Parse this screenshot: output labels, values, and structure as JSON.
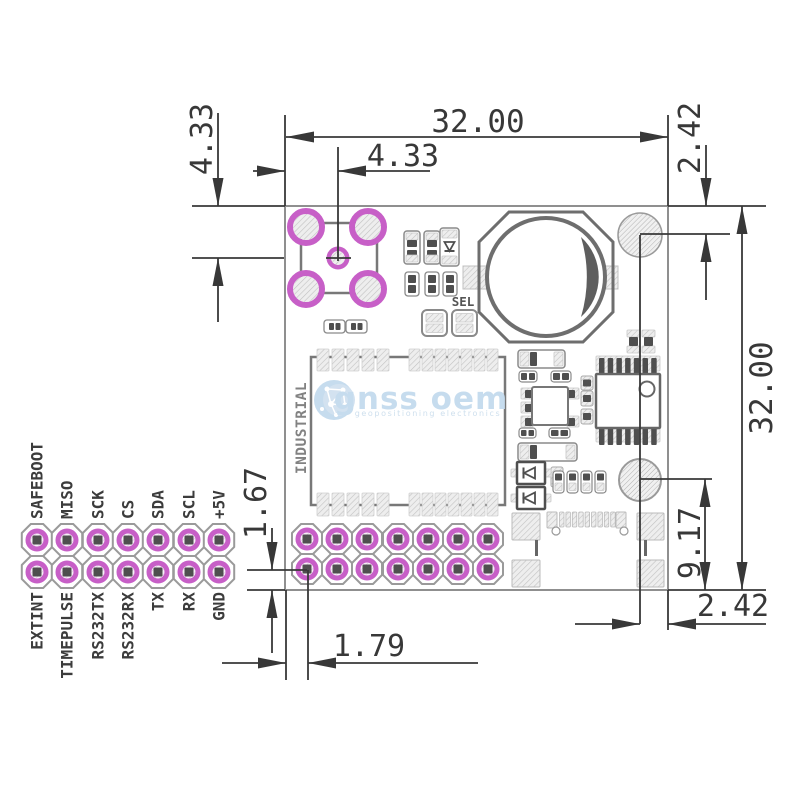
{
  "drawing": {
    "dimensions": {
      "board_width": "32.00",
      "board_height": "32.00",
      "antenna_offset_x": "4.33",
      "antenna_offset_y": "4.33",
      "hole_top_right_offset": "2.42",
      "hole_bottom_right_offset": "2.42",
      "hole_bottom_right_height": "9.17",
      "header_row_to_edge": "1.67",
      "header_col_to_edge": "1.79"
    },
    "module_label": "INDUSTRIAL",
    "sel_label": "SEL",
    "pin_header": {
      "top_labels": [
        "SAFEBOOT",
        "MISO",
        "SCK",
        "CS",
        "SDA",
        "SCL",
        "+5V"
      ],
      "bottom_labels": [
        "EXTINT",
        "TIMEPULSE",
        "RS232TX",
        "RS232RX",
        "TX",
        "RX",
        "GND"
      ]
    },
    "watermark": {
      "brand": "gnss oem",
      "tagline": "geopositioning electronics"
    },
    "colors": {
      "pad_magenta": "#c75fc7",
      "dimension": "#383838",
      "board_outline": "#8f8f8f",
      "watermark_blue": "#c6dcee"
    }
  }
}
